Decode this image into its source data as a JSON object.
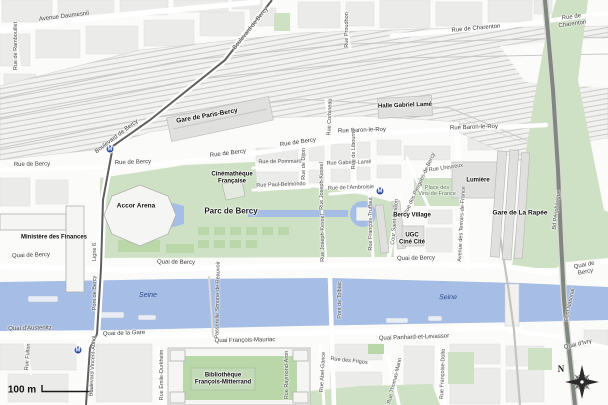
{
  "colors": {
    "water": "#a6bde5",
    "park": "#cfe1c5",
    "lawn": "#bad7aa",
    "block": "#ebebe9",
    "building": "#e0e0de",
    "peripherique": "#7f877f",
    "metro_line": "#5f5f5f",
    "metro_icon": "#26489c",
    "water_label": "#2d4f8e",
    "green_label": "#5c7355"
  },
  "legend": {
    "scale_label": "100 m",
    "north_label": "N"
  },
  "metro": {
    "glyph": "M",
    "stations": [
      {
        "x": 110,
        "y": 149
      },
      {
        "x": 380,
        "y": 191
      },
      {
        "x": 78,
        "y": 350
      }
    ]
  },
  "labels": [
    {
      "text": "Avenue Daumesnil",
      "x": 64,
      "y": 17,
      "rot": -7,
      "cls": "st"
    },
    {
      "text": "Rue de Rambouillet",
      "x": 16,
      "y": 46,
      "rot": -90,
      "cls": "sm"
    },
    {
      "text": "Boulevard de Bercy",
      "x": 251,
      "y": 29,
      "rot": -51,
      "cls": "st"
    },
    {
      "text": "Boulevard de Bercy",
      "x": 117,
      "y": 137,
      "rot": -37,
      "cls": "st"
    },
    {
      "text": "Rue de Charenton",
      "x": 476,
      "y": 29,
      "rot": -5,
      "cls": "st"
    },
    {
      "text": "Rue de Charenton",
      "x": 572,
      "y": 21,
      "rot": -8,
      "cls": "st"
    },
    {
      "text": "Rue Proudhon",
      "x": 347,
      "y": 30,
      "rot": -90,
      "cls": "sm"
    },
    {
      "text": "Rue Corbineau",
      "x": 330,
      "y": 117,
      "rot": -88,
      "cls": "sm"
    },
    {
      "text": "Rue de Bercy",
      "x": 32,
      "y": 165,
      "rot": -1,
      "cls": "st"
    },
    {
      "text": "Rue de Bercy",
      "x": 133,
      "y": 163,
      "rot": -2,
      "cls": "st"
    },
    {
      "text": "Rue de Bercy",
      "x": 228,
      "y": 154,
      "rot": -7,
      "cls": "st"
    },
    {
      "text": "Rue de Bercy",
      "x": 298,
      "y": 143,
      "rot": -8,
      "cls": "st"
    },
    {
      "text": "Rue Baron-le-Roy",
      "x": 362,
      "y": 131,
      "rot": -2,
      "cls": "st"
    },
    {
      "text": "Rue Baron-le-Roy",
      "x": 474,
      "y": 128,
      "rot": -2,
      "cls": "st"
    },
    {
      "text": "Rue de Pommard",
      "x": 280,
      "y": 162,
      "rot": -1,
      "cls": "sm"
    },
    {
      "text": "Rue Paul-Belmondo",
      "x": 281,
      "y": 185,
      "rot": -2,
      "cls": "sm"
    },
    {
      "text": "Rue Gabriel-Lamé",
      "x": 349,
      "y": 163,
      "rot": -2,
      "cls": "sm"
    },
    {
      "text": "Rue de l'Ambroisie",
      "x": 351,
      "y": 188,
      "rot": -2,
      "cls": "sm"
    },
    {
      "text": "Rue de Dijon",
      "x": 304,
      "y": 164,
      "rot": -90,
      "cls": "sm"
    },
    {
      "text": "Rue Joseph-Kessel",
      "x": 322,
      "y": 186,
      "rot": -90,
      "cls": "sm"
    },
    {
      "text": "Rue Joseph-Kessel",
      "x": 323,
      "y": 238,
      "rot": -90,
      "cls": "sm"
    },
    {
      "text": "Rue de Libourne",
      "x": 354,
      "y": 149,
      "rot": -90,
      "cls": "sm"
    },
    {
      "text": "Rue François-Truffaut",
      "x": 371,
      "y": 224,
      "rot": -90,
      "cls": "sm"
    },
    {
      "text": "Cour Saint-Émilion",
      "x": 395,
      "y": 222,
      "rot": -85,
      "cls": "sm"
    },
    {
      "text": "Rue des Pirogues-de-Bercy",
      "x": 420,
      "y": 184,
      "rot": -65,
      "cls": "sm"
    },
    {
      "text": "Avenue des Terroirs-de-France",
      "x": 462,
      "y": 224,
      "rot": -87,
      "cls": "sm"
    },
    {
      "text": "Rue Lheureux",
      "x": 446,
      "y": 168,
      "rot": -8,
      "cls": "sm"
    },
    {
      "text": "Ligne 6",
      "x": 95,
      "y": 252,
      "rot": -90,
      "cls": "sm"
    },
    {
      "text": "Rue Fulton",
      "x": 28,
      "y": 357,
      "rot": -86,
      "cls": "sm"
    },
    {
      "text": "Boulevard Vincent-Auriol",
      "x": 93,
      "y": 366,
      "rot": -87,
      "cls": "sm"
    },
    {
      "text": "Rue Émile-Durkheim",
      "x": 162,
      "y": 375,
      "rot": -90,
      "cls": "sm"
    },
    {
      "text": "Rue Raymond-Aron",
      "x": 287,
      "y": 375,
      "rot": -90,
      "cls": "sm"
    },
    {
      "text": "Rue Abel-Gance",
      "x": 323,
      "y": 372,
      "rot": -87,
      "cls": "sm"
    },
    {
      "text": "Rue des Frigos",
      "x": 349,
      "y": 361,
      "rot": 6,
      "cls": "sm"
    },
    {
      "text": "Rue Thomas-Mann",
      "x": 395,
      "y": 381,
      "rot": -76,
      "cls": "sm"
    },
    {
      "text": "Rue Françoise-Dolto",
      "x": 443,
      "y": 374,
      "rot": -88,
      "cls": "sm"
    },
    {
      "text": "Quai de Bercy",
      "x": 31,
      "y": 256,
      "rot": -2,
      "cls": "st"
    },
    {
      "text": "Quai de Bercy",
      "x": 176,
      "y": 263,
      "rot": 1,
      "cls": "st"
    },
    {
      "text": "Quai de Bercy",
      "x": 416,
      "y": 259,
      "rot": -1,
      "cls": "st"
    },
    {
      "text": "Quai de Bercy",
      "x": 585,
      "y": 269,
      "rot": -11,
      "cls": "st"
    },
    {
      "text": "Quai d'Austerlitz",
      "x": 30,
      "y": 329,
      "rot": -1,
      "cls": "st"
    },
    {
      "text": "Quai de la Gare",
      "x": 124,
      "y": 334,
      "rot": -2,
      "cls": "st"
    },
    {
      "text": "Quai François-Mauriac",
      "x": 245,
      "y": 341,
      "rot": -1,
      "cls": "st"
    },
    {
      "text": "Quai Panhard-et-Levassor",
      "x": 414,
      "y": 338,
      "rot": -2,
      "cls": "st"
    },
    {
      "text": "Quai d'Ivry",
      "x": 578,
      "y": 345,
      "rot": -13,
      "cls": "st"
    },
    {
      "text": "Pont de Bercy",
      "x": 95,
      "y": 293,
      "rot": -90,
      "cls": "sm"
    },
    {
      "text": "Passerelle Simone-de-Beauvoir",
      "x": 218,
      "y": 300,
      "rot": -89,
      "cls": "sm"
    },
    {
      "text": "Pont de Tolbiac",
      "x": 340,
      "y": 300,
      "rot": -90,
      "cls": "sm"
    },
    {
      "text": "Pont National",
      "x": 570,
      "y": 305,
      "rot": -78,
      "cls": "sm"
    },
    {
      "text": "Bd Périphérique",
      "x": 557,
      "y": 210,
      "rot": -83,
      "cls": "sm"
    },
    {
      "text": "Seine",
      "x": 148,
      "y": 296,
      "rot": 0,
      "cls": "water"
    },
    {
      "text": "Seine",
      "x": 448,
      "y": 298,
      "rot": -1,
      "cls": "water"
    },
    {
      "text": "Gare de Paris-Bercy",
      "x": 207,
      "y": 116,
      "rot": -10,
      "cls": "pl"
    },
    {
      "text": "Halle Gabriel Lamé",
      "x": 405,
      "y": 106,
      "rot": -2,
      "cls": "pls"
    },
    {
      "text": "Accor Arena",
      "x": 136,
      "y": 206,
      "rot": 0,
      "cls": "pl"
    },
    {
      "text": "Ministère des Finances",
      "x": 54,
      "y": 238,
      "rot": 0,
      "cls": "pls"
    },
    {
      "text": "Parc de Bercy",
      "x": 231,
      "y": 212,
      "rot": 0,
      "cls": "park"
    },
    {
      "text": "Cinémathèque\nFrançaise",
      "x": 232,
      "y": 178,
      "rot": 0,
      "cls": "pls"
    },
    {
      "text": "Bercy Village",
      "x": 412,
      "y": 216,
      "rot": 0,
      "cls": "pls"
    },
    {
      "text": "UGC\nCiné Cité",
      "x": 412,
      "y": 239,
      "rot": 0,
      "cls": "pls"
    },
    {
      "text": "Gare de La Rapée",
      "x": 520,
      "y": 213,
      "rot": 0,
      "cls": "pl"
    },
    {
      "text": "Lumière",
      "x": 478,
      "y": 181,
      "rot": 0,
      "cls": "pls"
    },
    {
      "text": "Place des\nVins-de-France",
      "x": 437,
      "y": 191,
      "rot": 0,
      "cls": "green"
    },
    {
      "text": "Bibliothèque\nFrançois-Mitterrand",
      "x": 223,
      "y": 379,
      "rot": 0,
      "cls": "pls"
    }
  ]
}
